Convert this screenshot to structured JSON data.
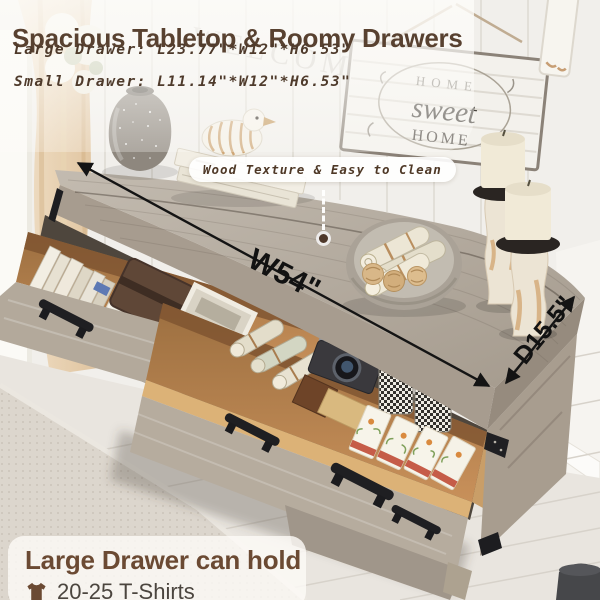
{
  "header": {
    "title": "Spacious Tabletop & Roomy Drawers",
    "specs": [
      {
        "label": "Large Drawer:",
        "value": "L23.77\"*W12\"*H6.53\""
      },
      {
        "label": "Small Drawer:",
        "value": "L11.14\"*W12\"*H6.53\""
      }
    ]
  },
  "callout": {
    "text": "Wood Texture & Easy to Clean"
  },
  "dimensions": {
    "width_label": "W54\"",
    "depth_label": "D15.5\""
  },
  "footer": {
    "title": "Large Drawer can hold",
    "capacity": "20-25 T-Shirts",
    "icon": "tshirt-icon"
  },
  "scene": {
    "wall_sign": {
      "line1": "HOME",
      "line2": "sweet",
      "line3": "HOME"
    },
    "wall_letters": "WELCOME",
    "objects": [
      "speckled-vase",
      "book-stack",
      "duck-figurine",
      "round-tray",
      "paper-rolls",
      "rattan-balls",
      "pillar-candles",
      "open-drawer-books",
      "leather-journal",
      "picture-frame",
      "linen-rolls",
      "vintage-camera",
      "wood-boxes",
      "patterned-canisters",
      "tea-boxes",
      "woven-rug",
      "beige-curtain"
    ]
  },
  "colors": {
    "title_brown": "#584130",
    "annotation_black": "#141414",
    "callout_text": "#4e3826",
    "footer_title": "#6b4a33",
    "footer_text": "#4b453e"
  }
}
